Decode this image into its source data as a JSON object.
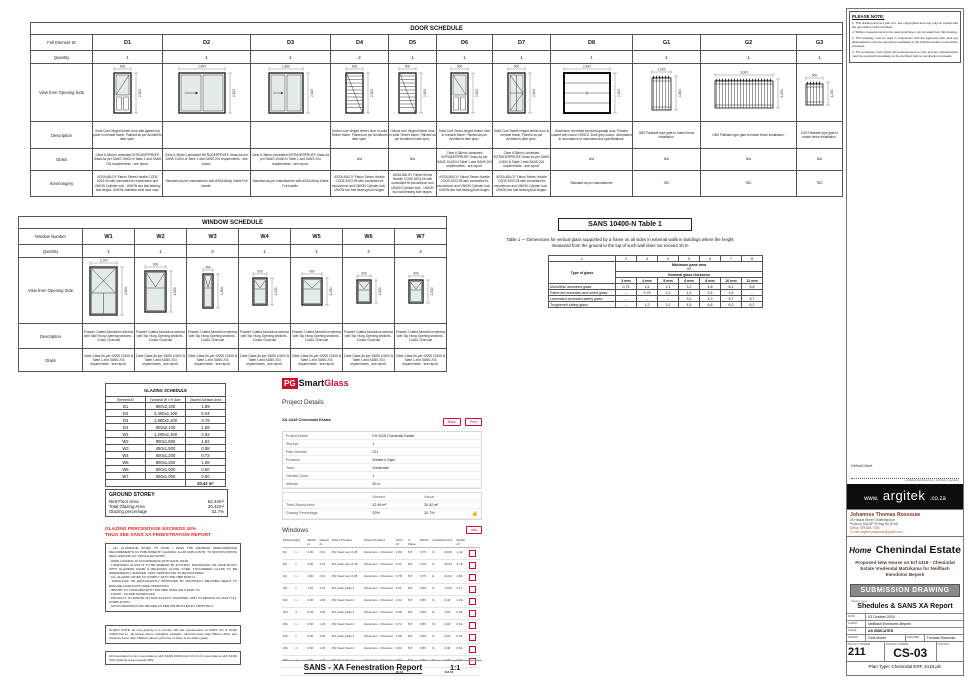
{
  "colors": {
    "accent_red": "#C8102E",
    "warning_red": "#E02B20",
    "glass_tint": "#E3ECE6"
  },
  "door_schedule": {
    "title": "DOOR SCHEDULE",
    "row_labels": {
      "id": "Full Element ID",
      "qty": "Quantity",
      "view": "View from Opening Side",
      "description": "Description",
      "glass": "Glass",
      "ironmongery": "Ironmongery"
    },
    "columns": [
      {
        "id": "D1",
        "qty": "1",
        "w": "900",
        "h": "2,100",
        "wn": 900,
        "hn": 2100,
        "draw": "glazedTopA",
        "description": "Solid Core hinged timber door with glazed top pane in meranti frame. Painted as per Architect's later spec.",
        "glass": "Clear 6.38mm Laminated INTRUDERPRUFE Glass As per SANS 10400-N Table 1 and SANS 204 requirements - see report.",
        "ironmongery": "ASSA ABLOY Fabori Series Handle CODE 6203-05 with concealed fix escutcheon and UNION Cylinder lock - UNION two ball bearing butt hinges. UNION stainless steel door stop."
      },
      {
        "id": "D2",
        "qty": "1",
        "w": "2,400",
        "h": "2,100",
        "wn": 2400,
        "hn": 2100,
        "draw": "slide2",
        "description": "",
        "glass": "Clear 6.38mm Laminated INTRUDERPRUFE Glass As per SANS 10400-N Table 1 and SANS 204 requirements - see report.",
        "ironmongery": "Standard as per manufacturer with ASSA Abloy Gable Full handle."
      },
      {
        "id": "D3",
        "qty": "1",
        "w": "1,800",
        "h": "2,100",
        "wn": 1800,
        "hn": 2100,
        "draw": "slide2",
        "description": "",
        "glass": "Clear 6.38mm Laminated INTRUDERPRUFE Glass As per SANS 10400-N Table 1 and SANS 204 requirements - see report.",
        "ironmongery": "Standard as per manufacturer with ASSA Abloy Gable Full handle."
      },
      {
        "id": "D4",
        "qty": "2",
        "w": "900",
        "h": "2,100",
        "wn": 900,
        "hn": 2100,
        "draw": "louvre",
        "description": "Hollow core hinged timber door in solid Timber frame. Painted as per Architect's later spec.",
        "glass": "N/A",
        "ironmongery": "ASSA ABLOY Fabori Series Handle CODE 6203-05 with concealed fix escutcheon and UNION Cylinder lock - UNION two ball bearing butt hinges."
      },
      {
        "id": "D5",
        "qty": "1",
        "w": "900",
        "h": "2,100",
        "wn": 900,
        "hn": 2100,
        "draw": "louvre",
        "description": "Hollow core hinged timber door in solid Timber frame. Painted as per Architect's later spec.",
        "glass": "N/A",
        "ironmongery": "ASSA ABLOY Fabori Series Handle CODE 6203-05 with concealed fix escutcheon and UNION Cylinder lock - UNION two ball bearing butt hinges."
      },
      {
        "id": "D6",
        "qty": "1",
        "w": "900",
        "h": "2,100",
        "wn": 900,
        "hn": 2100,
        "draw": "glazedTopB",
        "description": "Solid Core Sedra hinged timber door in meranti frame. Painted as per Architect's later spec.",
        "glass": "Clear 6.38mm Laminated INTRUDERPRUFE Glass As per SANS 10400-N Table 1 and SANS 204 requirements - see report.",
        "ironmongery": "ASSA ABLOY Fabori Series Handle CODE 6203-05 with concealed fix escutcheon and UNION Cylinder lock - UNION two ball bearing butt hinges."
      },
      {
        "id": "D7",
        "qty": "1",
        "w": "900",
        "h": "2,100",
        "wn": 900,
        "hn": 2100,
        "draw": "panes4",
        "description": "Solid Core Stable hinged timber door in meranti frame. Painted as per Architect's later spec.",
        "glass": "Clear 6.38mm Laminated INTRUDERPRUFE Glass As per SANS 10400-N Table 1 and SANS 204 requirements - see report.",
        "ironmongery": "ASSA ABLOY Fabori Series Handle CODE 6203-05 with concealed fix escutcheon and UNION Cylinder lock - UNION two ball bearing butt hinges."
      },
      {
        "id": "D8",
        "qty": "1",
        "w": "2,400",
        "h": "2,100",
        "wn": 2400,
        "hn": 2100,
        "draw": "garage",
        "description": "Aluminium overhead sectional garage door. Powder coated with colour VISSOL 'Dark grey colour'. Automated in accordance to manufacturers specifications.",
        "glass": "N/A",
        "ironmongery": "Standard as per manufacturer"
      },
      {
        "id": "G1",
        "qty": "1",
        "w": "1,000",
        "h": "1,800",
        "wn": 1000,
        "hn": 1800,
        "draw": "palisade",
        "description": "GBS Palisade type gate to match fence installation.",
        "glass": "N/A",
        "ironmongery": "TBC"
      },
      {
        "id": "G2",
        "qty": "1",
        "w": "3,000",
        "h": "1,500",
        "wn": 3000,
        "hn": 1500,
        "draw": "palisade",
        "description": "GBS Palisade type gate to match fence installation.",
        "glass": "N/A",
        "ironmongery": "TBC"
      },
      {
        "id": "G3",
        "qty": "1",
        "w": "900",
        "h": "1,200",
        "wn": 900,
        "hn": 1200,
        "draw": "palisade",
        "description": "CAS Palisade type gate to match fence installation.",
        "glass": "N/A",
        "ironmongery": "TBC"
      }
    ]
  },
  "window_schedule": {
    "title": "WINDOW SCHEDULE",
    "row_labels": {
      "number": "Window Number",
      "qty": "Quantity",
      "view": "View from Opening Side",
      "description": "Description",
      "glass": "Glass"
    },
    "columns": [
      {
        "id": "W1",
        "qty": "1",
        "w": "1,200",
        "h": "2,100",
        "wn": 1200,
        "hn": 2100,
        "draw": "crossTop2",
        "description": "Powder Coated Aluminium window with Side Hung Opening sections - Colour Charcoal",
        "glass": "Clear Glass As per SANS 10400-N Table 1 and SANS 204 requirements - see report."
      },
      {
        "id": "W2",
        "qty": "1",
        "w": "900",
        "h": "1,800",
        "wn": 900,
        "hn": 1800,
        "draw": "topHung",
        "description": "Powder Coated Aluminium window with Top Hung Opening sections - Colour Charcoal",
        "glass": "Clear Glass As per SANS 10400-N Table 1 and SANS 204 requirements - see report."
      },
      {
        "id": "W3",
        "qty": "3",
        "w": "450",
        "h": "1,500",
        "wn": 450,
        "hn": 1500,
        "draw": "topHung",
        "description": "Powder Coated Aluminium window with Top Hung Opening sections - Colour Charcoal",
        "glass": "Clear Glass As per SANS 10400-N Table 1 and SANS 204 requirements - see report."
      },
      {
        "id": "W4",
        "qty": "1",
        "w": "600",
        "h": "1,200",
        "wn": 600,
        "hn": 1200,
        "draw": "topHung",
        "description": "Powder Coated Aluminium window with Top Hung Opening sections - Colour Charcoal",
        "glass": "Clear Glass As per SANS 10400-N Table 1 and SANS 204 requirements - see report."
      },
      {
        "id": "W5",
        "qty": "1",
        "w": "900",
        "h": "1,200",
        "wn": 900,
        "hn": 1200,
        "draw": "topHung",
        "description": "Powder Coated Aluminium window with Top Hung Opening sections - Colour Charcoal",
        "glass": "Clear Glass As per SANS 10400-N Table 1 and SANS 204 requirements - see report."
      },
      {
        "id": "W6",
        "qty": "4",
        "w": "600",
        "h": "1,000",
        "wn": 600,
        "hn": 1000,
        "draw": "topHung",
        "description": "Powder Coated Aluminium window with Top Hung Opening sections - Colour Charcoal",
        "glass": "Clear Glass As per SANS 10400-N Table 1 and SANS 204 requirements - see report."
      },
      {
        "id": "W7",
        "qty": "4",
        "w": "600",
        "h": "1,000",
        "wn": 600,
        "hn": 1000,
        "draw": "topHung",
        "description": "Powder Coated Aluminium window with Top Hung Opening sections - Colour Charcoal",
        "glass": "Clear Glass As per SANS 10400-N Table 1 and SANS 204 requirements - see report."
      }
    ]
  },
  "sans_table": {
    "title": "SANS 10400-N Table 1",
    "caption": "Table 1 — Dimensions for vertical glass supported by a frame on all sides in external walls in buildings where the height measured from the ground to the top of such wall does not exceed 10 m",
    "col_numbers": [
      "1",
      "2",
      "3",
      "4",
      "5",
      "6",
      "7",
      "8"
    ],
    "type_header": "Type of glass",
    "area_header": "Maximum pane area",
    "area_unit": "m²",
    "thickness_header": "Nominal glass thickness",
    "thicknesses": [
      "3 mm",
      "4 mm",
      "5 mm",
      "6 mm",
      "8 mm",
      "10 mm",
      "12 mm"
    ],
    "rows": [
      {
        "type": "Monolithic annealed glass",
        "values": [
          "0,75",
          "1,5",
          "2,1",
          "3,2",
          "4,8",
          "6,2",
          "6,8"
        ]
      },
      {
        "type": "Patterned annealed and wired glass",
        "values": [
          "–",
          "0,75",
          "1,2",
          "1,4",
          "2,6",
          "3,4",
          "–"
        ]
      },
      {
        "type": "Laminated annealed safety glass",
        "values": [
          "–",
          "–",
          "–",
          "3,2",
          "4,3",
          "5,7",
          "5,7"
        ]
      },
      {
        "type": "Toughened safety glass",
        "values": [
          "–",
          "1,2",
          "3,2",
          "4,5",
          "6,8",
          "6,2",
          "6,2"
        ]
      }
    ]
  },
  "glazing_schedule": {
    "title": "GLAZING SCHEDULE",
    "headers": [
      "Element ID",
      "Nominal W x H Size",
      "Glazed Surface Area"
    ],
    "rows": [
      [
        "D1",
        "900x2,100",
        "1.89"
      ],
      [
        "D2",
        "2,400x2,100",
        "5.04"
      ],
      [
        "D3",
        "1,800x2,100",
        "3.78"
      ],
      [
        "D4",
        "900x2,100",
        "1.89"
      ],
      [
        "W1",
        "1,200x2,100",
        "2.52"
      ],
      [
        "W2",
        "900x1,800",
        "1.62"
      ],
      [
        "W3",
        "450x1,500",
        "0.68"
      ],
      [
        "W4",
        "600x1,200",
        "0.72"
      ],
      [
        "W5",
        "900x1,200",
        "1.08"
      ],
      [
        "W6",
        "600x1,000",
        "0.60"
      ],
      [
        "W7",
        "600x1,000",
        "0.60"
      ]
    ],
    "total": "20.42 m²"
  },
  "ground_storey": {
    "title": "GROUND STOREY",
    "rows": [
      [
        "Nett Floor Area",
        "62.44m²"
      ],
      [
        "Total Glazing Area",
        "20.42m²"
      ],
      [
        "Glazing percentage",
        "32.7%"
      ]
    ],
    "warning1": "GLAZING PERCENTAGE EXCEEDS 20%",
    "warning2": "THUS SEE SANS XA FENESTRATION REPORT"
  },
  "notes": {
    "general": [
      "- ALL ALUMINIUM WORK TO HAVE / PASS THE MINIMUM PERFORMANCE REQUIREMENTS AS PUBLISHED BY AAAMSA. ALUM SUB-CONTR. TO SPATIOS (PROS) SEAL AROUND ALL INSTALLED WORK.",
      "- WIND LOADING IN ACCORDANCE WITH SANS 10160.",
      "- LAMINATED GLASS IS TO BE MARKED BY ETCHING, ENGRAVING OR SAND BLAST WITH GLAZIERS NAME & RELEVANT GLASS CODE. TOUGHENED GLASS TO BE PERMANENTLY MARKED. TEST CERTIFICATE TO BE PROVIDED.",
      "- ALL GLAZING WORK TO COMPLY WITH THE NBR PART N.",
      "- 'MODILFILE' OR EQUIVALENTLY APPROVED BY ARCHITECT WEATHER SEALS TO ENSURE A DRAUGHT FREE OPERATION.",
      "- IMPORT TO CONFORM WITH THE NBR SANS 204 & PART XA.",
      "- FINISH - AS PER SCHEDULES.",
      "- PRODUCT TO ARRIVE ON SITE PLASTIC WRAPPED, AND TO REMAIN AS SUCH TILL COMPLETION.",
      "- SHOP DRAWINGS MAY BE REQ AS PER INSTRUCTED BY ARCHITECT"
    ],
    "client": "CLIENT NOTE: all new glazing is to comply with the requirements of SANS 'XA' & SANS 10400 Part N - all access doors, sidelights, fanlights, windows lower than 500mm AFFL and windows lower than 1800mm above pitch line of stairs to be safety glass.",
    "fenestration": "All fenestration to be in accordance with SANS 10400 part XA 4.4.2 in accordance with SANS 204 if glazing area exceeds 20%"
  },
  "pg_report": {
    "logo": {
      "pg": "PG",
      "smart": "Smart",
      "glass": "Glass"
    },
    "section1": "Project Details",
    "project_ref": "XA 4418 Chenindal Estate",
    "buttons": [
      "Back",
      "Print"
    ],
    "details": [
      [
        "Project Name",
        "Erf 4418 Chenindal Estate"
      ],
      [
        "Storeys",
        "1"
      ],
      [
        "Plan Number",
        "211"
      ],
      [
        "Province",
        "Western Cape"
      ],
      [
        "Town",
        "Vredendal"
      ],
      [
        "Climatic Zone",
        "1"
      ],
      [
        "Altitude",
        "30 m"
      ]
    ],
    "summary": {
      "headers": [
        "Allowed",
        "Actual"
      ],
      "rows": [
        [
          "Total Glazed Area",
          "12.49 m²",
          "20.42 m²"
        ],
        [
          "Glazing Percentage",
          "20%",
          "32.7%"
        ]
      ]
    },
    "windows_title": "Windows",
    "windows_button": "Add",
    "windows_headers": [
      "Element",
      "Qty",
      "Width m",
      "Height m",
      "Glass Product",
      "Frame Product",
      "Area m²",
      "U Value",
      "SHGC",
      "Azimuth",
      "Cond.",
      "SHGC m²",
      ""
    ],
    "windows_rows": [
      [
        "D1",
        "1",
        "0.90",
        "2.10",
        "PG Clear Lam 6.38",
        "Aluminium - Charcoal",
        "1.89",
        "5.8",
        "0.75",
        "N",
        "10.96",
        "1.42"
      ],
      [
        "D2",
        "1",
        "2.40",
        "2.10",
        "PG Clear Lam 6.38",
        "Aluminium - Charcoal",
        "5.04",
        "5.8",
        "0.75",
        "N",
        "29.23",
        "3.78"
      ],
      [
        "D3",
        "1",
        "1.80",
        "2.10",
        "PG Clear Lam 6.38",
        "Aluminium - Charcoal",
        "3.78",
        "5.8",
        "0.75",
        "E",
        "21.92",
        "2.84"
      ],
      [
        "W1",
        "1",
        "1.20",
        "2.10",
        "PG Clear Float 4",
        "Aluminium - Charcoal",
        "2.52",
        "5.8",
        "0.86",
        "N",
        "14.62",
        "2.17"
      ],
      [
        "W2",
        "1",
        "0.90",
        "1.80",
        "PG Clear Float 4",
        "Aluminium - Charcoal",
        "1.62",
        "5.8",
        "0.86",
        "S",
        "9.40",
        "1.39"
      ],
      [
        "W3",
        "3",
        "0.45",
        "1.50",
        "PG Clear Float 4",
        "Aluminium - Charcoal",
        "0.68",
        "5.8",
        "0.86",
        "E",
        "3.92",
        "0.58"
      ],
      [
        "W4",
        "1",
        "0.60",
        "1.20",
        "PG Clear Float 4",
        "Aluminium - Charcoal",
        "0.72",
        "5.8",
        "0.86",
        "W",
        "4.18",
        "0.62"
      ],
      [
        "W5",
        "1",
        "0.90",
        "1.20",
        "PG Clear Float 4",
        "Aluminium - Charcoal",
        "1.08",
        "5.8",
        "0.86",
        "N",
        "6.26",
        "0.93"
      ],
      [
        "W6",
        "4",
        "0.60",
        "1.00",
        "PG Clear Float 4",
        "Aluminium - Charcoal",
        "0.60",
        "5.8",
        "0.86",
        "S",
        "3.48",
        "0.52"
      ],
      [
        "W7",
        "4",
        "0.60",
        "1.00",
        "PG Clear Float 4",
        "Aluminium - Charcoal",
        "0.60",
        "5.8",
        "0.86",
        "W",
        "3.48",
        "0.52"
      ]
    ],
    "totals": {
      "area": "20.42",
      "cond": "118.61"
    }
  },
  "footer": {
    "title": "SANS - XA Fenestration Report",
    "scale": "1:1"
  },
  "title_block": {
    "note_box": {
      "title": "PLEASE NOTE:",
      "items": [
        "This drawing and any part of it, are copyrighted and may only be copied with the permission of the Architect.",
        "Written measurements to be used at all times; do not scale from this drawing.",
        "This drawing must be read in conjunction with the approved plan and any discrepancies must be reported immediately to the Architect before construction proceeds.",
        "The contractor must check all measurements on site and any discrepancies must be reported immediately to the Architect before construction proceeds."
      ]
    },
    "client_label": "Kliënt/Client",
    "client_sub": "verifikasie handtekening / verification signature",
    "brand": {
      "www": "www.",
      "name": "argitek",
      "tld": ".co.za"
    },
    "architect": {
      "name": "Johannes Thomas Rossouw",
      "line1": "25 Hassel Street Onderstepoort",
      "line2": "Pr(Arch) SACAP St Reg No (Prof)",
      "cell": "Cell #: 079 603 7723",
      "email": "E-mail: argitek.jtrossouw@gmail.com"
    },
    "project": {
      "prefix": "Home",
      "name": "Chenindal Estate",
      "description": "Proposed New House on Erf 4418 - Chenindal Estate Vredendal Matzikama for Neilflash Eiendoms Beperk"
    },
    "stamp": "SUBMISSION DRAWING",
    "sheet_label": "drawing name",
    "sheet_name": "Shedules & SANS XA Report",
    "fields": {
      "date_label": "DATE",
      "date": "03 October 2024",
      "client_label": "CLIENT",
      "client": "Neilflash Eiendoms Beperk",
      "scale_label": "SCALE",
      "scale": "AS INDICATED",
      "drawn_label": "DRAWN",
      "drawn": "Cela Moller",
      "checked_label": "CHECKED",
      "checked": "Thomas Rossouw"
    },
    "numbers": {
      "project_label": "PROJECT NUMBER",
      "project": "211",
      "drawing_label": "DRAWING NUMBER",
      "drawing": "CS-03",
      "revision_label": "REVISION",
      "revision": ""
    },
    "plan_type": "Plan Type: Chenindal ERF 4418.pln"
  }
}
